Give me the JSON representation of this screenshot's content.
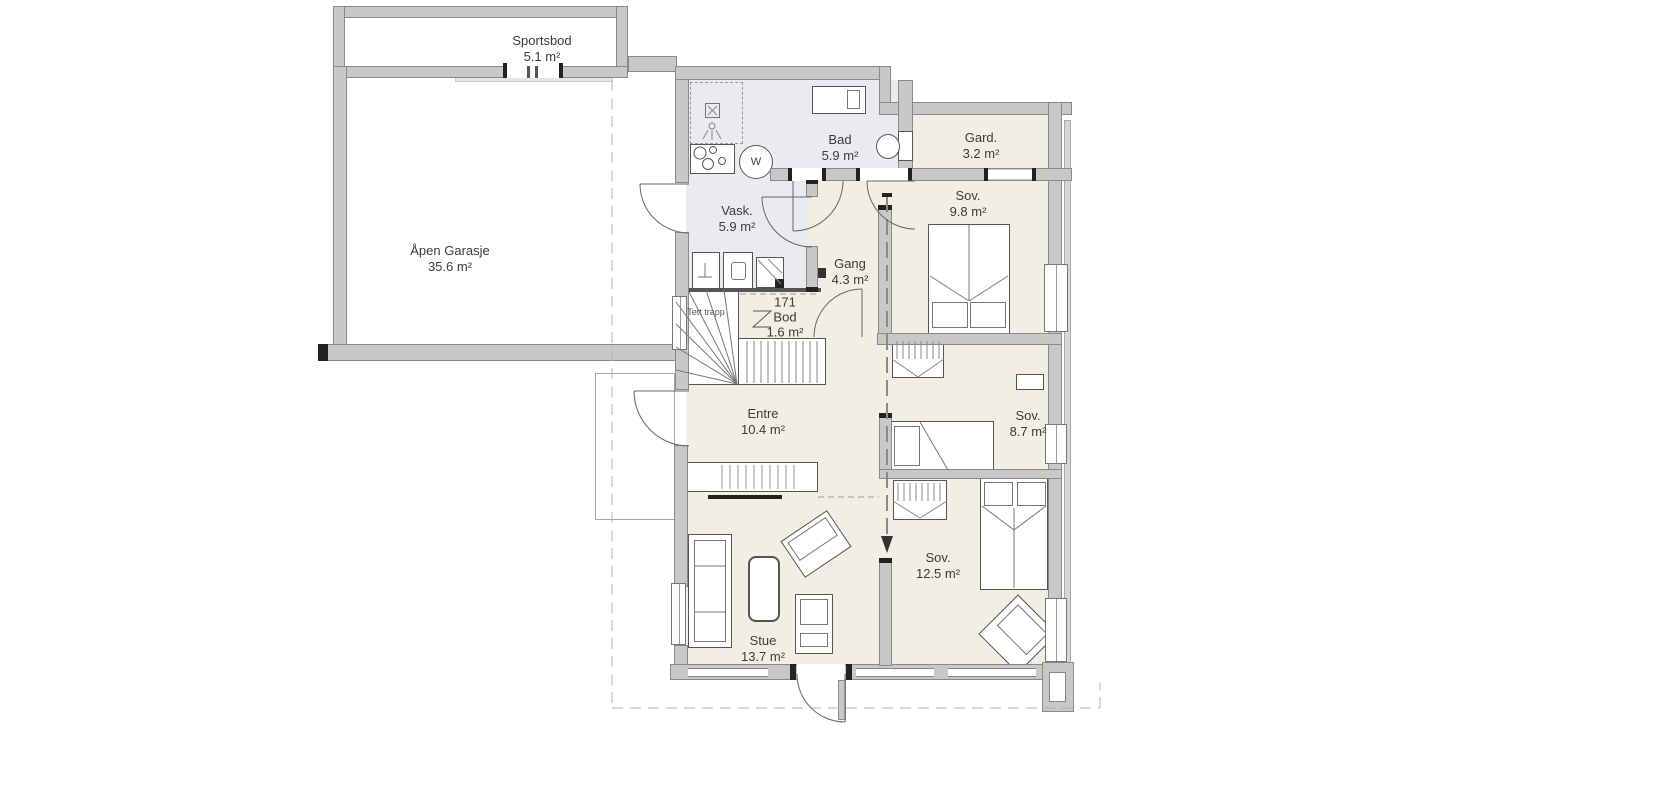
{
  "rooms": {
    "sportsbod": {
      "name": "Sportsbod",
      "area": "5.1 m²"
    },
    "garasje": {
      "name": "Åpen Garasje",
      "area": "35.6 m²"
    },
    "bad": {
      "name": "Bad",
      "area": "5.9 m²"
    },
    "gard": {
      "name": "Gard.",
      "area": "3.2 m²"
    },
    "sov_1": {
      "name": "Sov.",
      "area": "9.8 m²"
    },
    "vask": {
      "name": "Vask.",
      "area": "5.9 m²"
    },
    "gang": {
      "name": "Gang",
      "area": "4.3 m²"
    },
    "bod": {
      "number": "171",
      "name": "Bod",
      "area": "1.6 m²"
    },
    "trapp": {
      "name": "Tett trapp"
    },
    "entre": {
      "name": "Entre",
      "area": "10.4 m²"
    },
    "sov_2": {
      "name": "Sov.",
      "area": "8.7 m²"
    },
    "sov_3": {
      "name": "Sov.",
      "area": "12.5 m²"
    },
    "stue": {
      "name": "Stue",
      "area": "13.7 m²"
    }
  },
  "fixtures": {
    "washer_label": "W"
  },
  "colors": {
    "wall": "#c8c8c8",
    "wet_room": "#e9ebf1",
    "room": "#f1eee3",
    "outline": "#4a4a4a"
  }
}
